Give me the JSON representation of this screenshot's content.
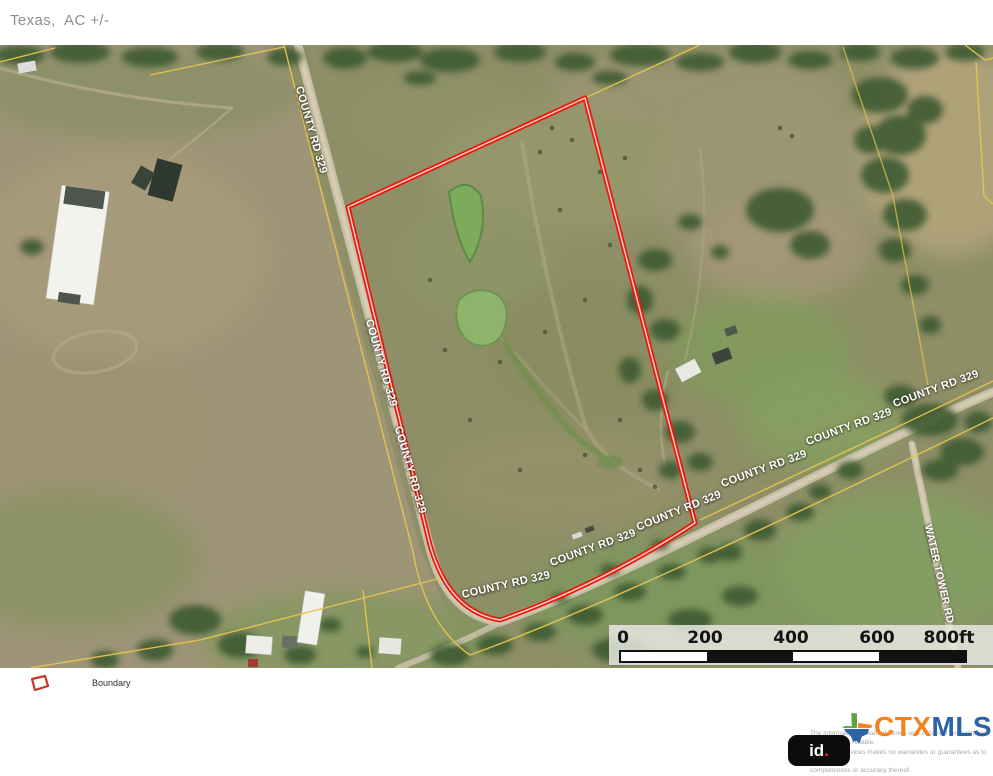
{
  "header": {
    "location_label": "Texas,  AC +/-"
  },
  "map": {
    "labels": {
      "county_road": "COUNTY RD 329",
      "water_tower_road": "WATER TOWER RD"
    },
    "legend": {
      "boundary_label": "Boundary"
    },
    "scale_bar": {
      "ticks": [
        "0",
        "200",
        "400",
        "600",
        "800ft"
      ]
    },
    "colors": {
      "boundary_red": "#ee1510",
      "parcel_line_yellow": "#e6c44f"
    }
  },
  "footer": {
    "disclaimer_lines": [
      "The information contained herein was obtained from sources",
      "deemed to be reliable.",
      " Land id™ Services makes no warranties or guarantees as to the",
      "completeness or accuracy thereof."
    ],
    "landid_logo_id": "id",
    "landid_logo_dot": ".",
    "ctxmls_logo": {
      "ctx": "CTX",
      "mls": "MLS"
    }
  }
}
